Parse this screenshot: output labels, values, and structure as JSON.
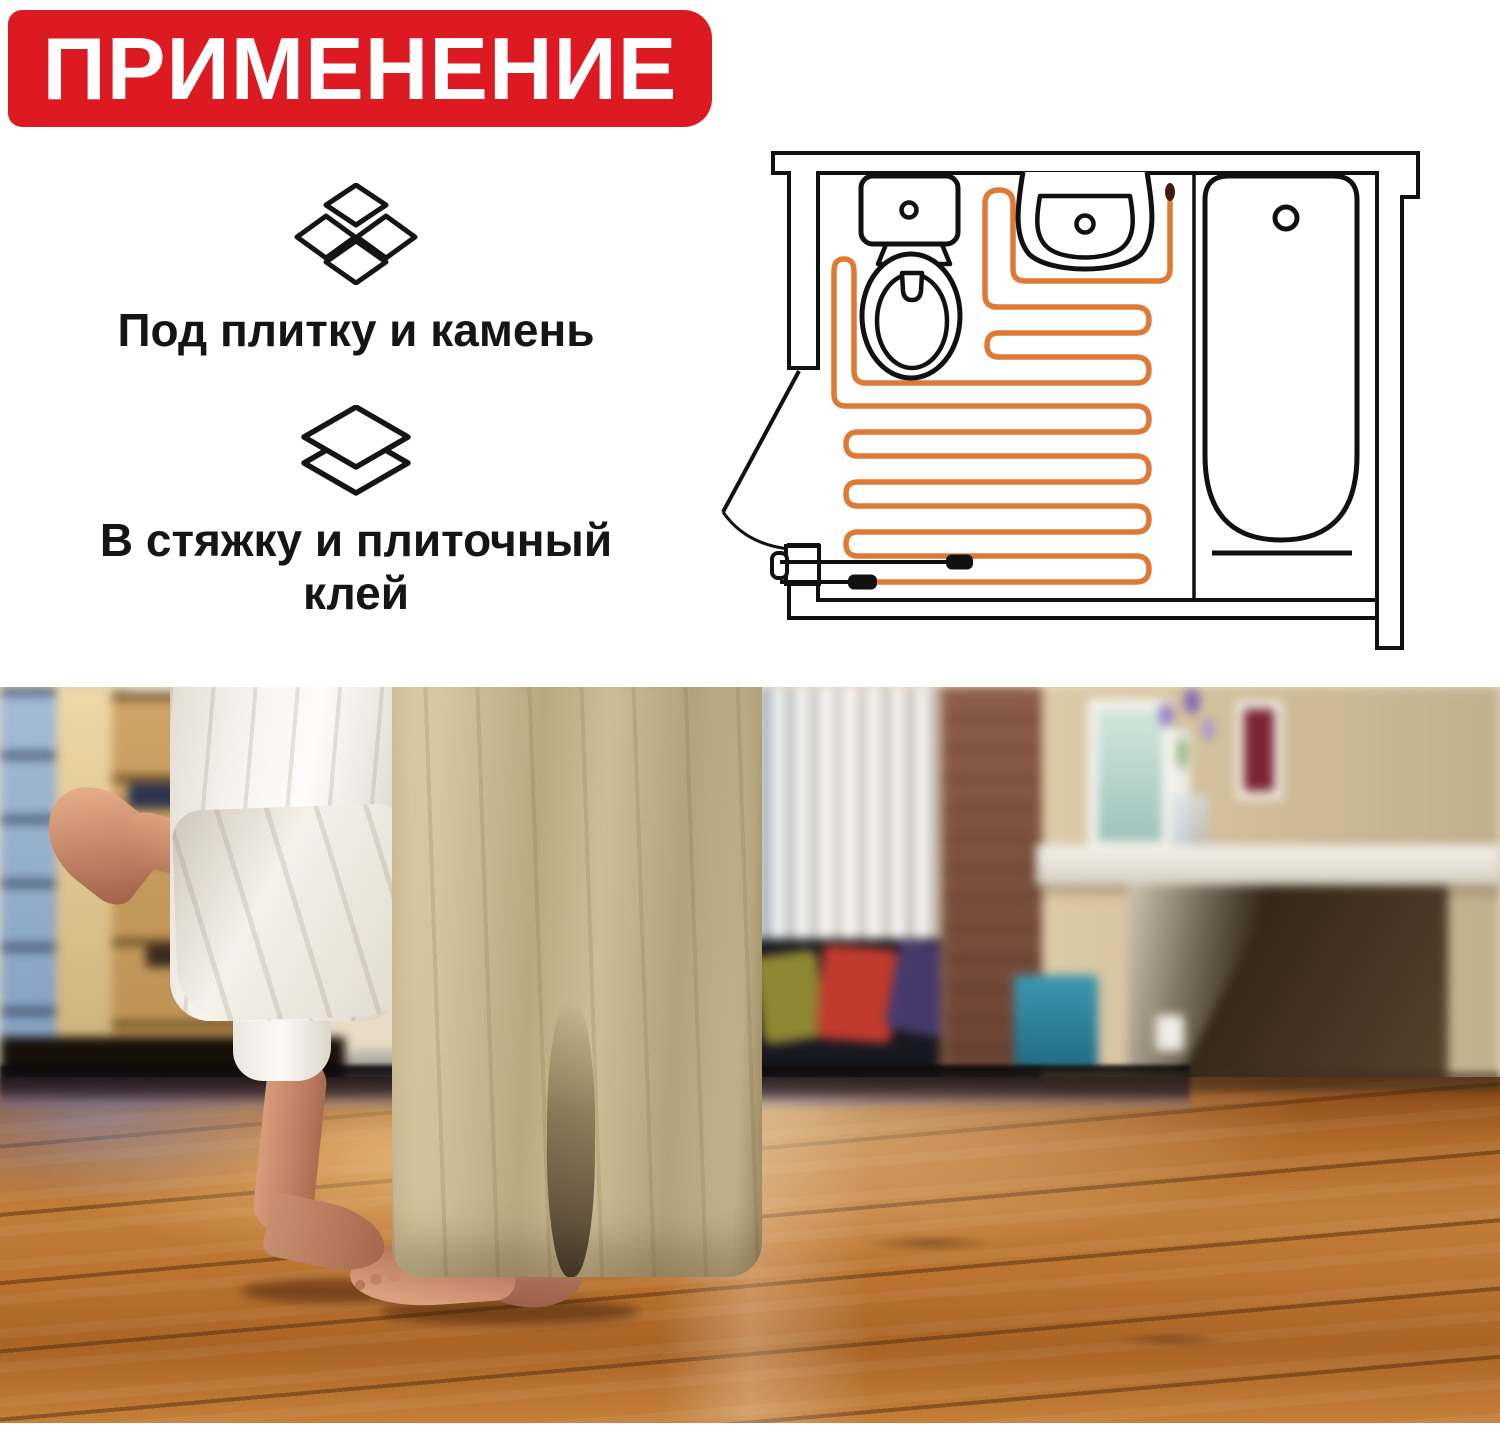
{
  "banner": {
    "title": "ПРИМЕНЕНИЕ",
    "bg_color": "#dd1a21",
    "text_color": "#ffffff"
  },
  "features": [
    {
      "icon": "tiles-icon",
      "label": "Под плитку и камень"
    },
    {
      "icon": "layers-icon",
      "label": "В стяжку и плиточный клей"
    }
  ],
  "diagram": {
    "name": "bathroom-heating-cable-floorplan",
    "cable_color": "#de7a36",
    "outline_color": "#111111",
    "fixtures": [
      "toilet",
      "sink",
      "bathtub",
      "door",
      "temperature-sensor",
      "power-lead"
    ]
  },
  "photo": {
    "description": "Пара босиком на тёплом деревянном полу в гостиной"
  }
}
